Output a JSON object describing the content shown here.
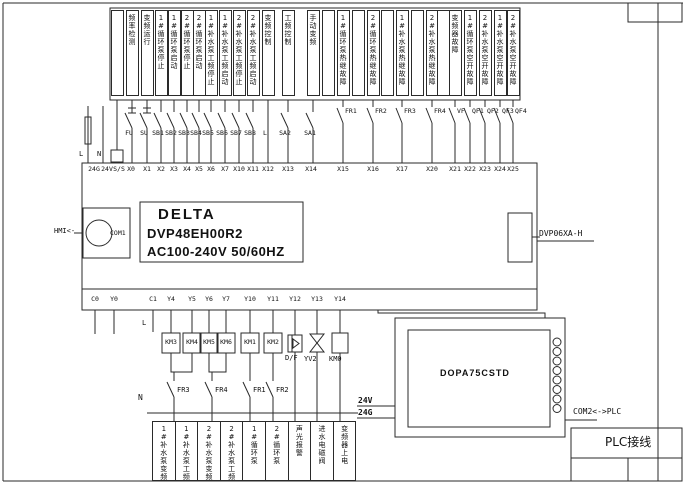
{
  "title_block": {
    "title": "PLC接线"
  },
  "plc": {
    "brand": "DELTA",
    "model": "DVP48EH00R2",
    "power": "AC100-240V 50/60HZ"
  },
  "ports": {
    "hmi_label": "HMI<-",
    "com1": "COM1",
    "expansion": "DVP06XA-H",
    "com2": "COM2<->PLC"
  },
  "hmi_panel": {
    "model": "DOPA75CSTD",
    "supply_24v": "24V",
    "supply_24g": "24G"
  },
  "power_in": {
    "l": "L",
    "n": "N"
  },
  "output_common": {
    "l": "L",
    "n": "N"
  },
  "load_labels": {
    "df": "D/F",
    "yv2": "YV2",
    "km0": "KM0"
  },
  "top_signals": [
    {
      "x": 117,
      "label": ""
    },
    {
      "x": 132,
      "label": "频率检测"
    },
    {
      "x": 147,
      "label": "变频运行"
    },
    {
      "x": 161,
      "label": "1#循环泵停止"
    },
    {
      "x": 174,
      "label": "1#循环泵启动"
    },
    {
      "x": 187,
      "label": "2#循环泵停止"
    },
    {
      "x": 199,
      "label": "2#循环泵启动"
    },
    {
      "x": 211,
      "label": "1#补水泵工频停止"
    },
    {
      "x": 225,
      "label": "1#补水泵工频启动"
    },
    {
      "x": 239,
      "label": "2#补水泵工频停止"
    },
    {
      "x": 253,
      "label": "2#补水泵工频启动"
    },
    {
      "x": 268,
      "label": "变频控制"
    },
    {
      "x": 288,
      "label": "工频控制"
    },
    {
      "x": 313,
      "label": "手动变频"
    },
    {
      "x": 328,
      "label": ""
    },
    {
      "x": 343,
      "label": "1#循环泵热继故障"
    },
    {
      "x": 358,
      "label": ""
    },
    {
      "x": 373,
      "label": "2#循环泵热继故障"
    },
    {
      "x": 387,
      "label": ""
    },
    {
      "x": 402,
      "label": "1#补水泵热继故障"
    },
    {
      "x": 417,
      "label": ""
    },
    {
      "x": 432,
      "label": "2#补水泵热继故障"
    },
    {
      "x": 443,
      "label": ""
    },
    {
      "x": 455,
      "label": "变频器故障"
    },
    {
      "x": 470,
      "label": "1#循环泵空开故障"
    },
    {
      "x": 485,
      "label": "2#补水泵空开故障"
    },
    {
      "x": 500,
      "label": "1#补水泵空开故障"
    },
    {
      "x": 513,
      "label": "2#补水泵空开故障"
    }
  ],
  "input_terminals": [
    {
      "x": 94,
      "label": "24G"
    },
    {
      "x": 107,
      "label": "24V"
    },
    {
      "x": 119,
      "label": "S/S"
    },
    {
      "x": 131,
      "label": "X0"
    },
    {
      "x": 147,
      "label": "X1"
    },
    {
      "x": 161,
      "label": "X2"
    },
    {
      "x": 174,
      "label": "X3"
    },
    {
      "x": 187,
      "label": "X4"
    },
    {
      "x": 199,
      "label": "X5"
    },
    {
      "x": 211,
      "label": "X6"
    },
    {
      "x": 225,
      "label": "X7"
    },
    {
      "x": 239,
      "label": "X10"
    },
    {
      "x": 253,
      "label": "X11"
    },
    {
      "x": 268,
      "label": "X12"
    },
    {
      "x": 288,
      "label": "X13"
    },
    {
      "x": 311,
      "label": "X14"
    },
    {
      "x": 343,
      "label": "X15"
    },
    {
      "x": 373,
      "label": "X16"
    },
    {
      "x": 402,
      "label": "X17"
    },
    {
      "x": 432,
      "label": "X20"
    },
    {
      "x": 455,
      "label": "X21"
    },
    {
      "x": 470,
      "label": "X22"
    },
    {
      "x": 485,
      "label": "X23"
    },
    {
      "x": 500,
      "label": "X24"
    },
    {
      "x": 513,
      "label": "X25"
    }
  ],
  "input_devices": [
    {
      "x": 117,
      "label": "",
      "type": "block"
    },
    {
      "x": 132,
      "label": "FU",
      "type": "fuse"
    },
    {
      "x": 147,
      "label": "SU",
      "type": "fuse"
    },
    {
      "x": 161,
      "label": "SB1",
      "type": "switch"
    },
    {
      "x": 174,
      "label": "SB2",
      "type": "switch"
    },
    {
      "x": 187,
      "label": "SB3",
      "type": "switch"
    },
    {
      "x": 199,
      "label": "SB4",
      "type": "switch"
    },
    {
      "x": 211,
      "label": "SB5",
      "type": "switch"
    },
    {
      "x": 225,
      "label": "SB6",
      "type": "switch"
    },
    {
      "x": 239,
      "label": "SB7",
      "type": "switch"
    },
    {
      "x": 253,
      "label": "SB8",
      "type": "switch"
    },
    {
      "x": 268,
      "label": "L",
      "type": "plain"
    },
    {
      "x": 288,
      "label": "SA2",
      "type": "switch"
    },
    {
      "x": 313,
      "label": "SA1",
      "type": "switch"
    },
    {
      "x": 343,
      "label": "FR1",
      "type": "relay"
    },
    {
      "x": 373,
      "label": "FR2",
      "type": "relay"
    },
    {
      "x": 402,
      "label": "FR3",
      "type": "relay"
    },
    {
      "x": 432,
      "label": "FR4",
      "type": "relay"
    },
    {
      "x": 455,
      "label": "VF",
      "type": "relay"
    },
    {
      "x": 470,
      "label": "QF1",
      "type": "relay"
    },
    {
      "x": 485,
      "label": "QF2",
      "type": "relay"
    },
    {
      "x": 500,
      "label": "QF3",
      "type": "relay"
    },
    {
      "x": 513,
      "label": "QF4",
      "type": "relay"
    }
  ],
  "output_terminals": [
    {
      "x": 95,
      "label": "C0",
      "to": 334,
      "stub": true
    },
    {
      "x": 114,
      "label": "Y0",
      "to": 334,
      "stub": true
    },
    {
      "x": 153,
      "label": "C1",
      "to": 332,
      "stub": true
    },
    {
      "x": 171,
      "label": "Y4",
      "to": 333
    },
    {
      "x": 192,
      "label": "Y5",
      "to": 333
    },
    {
      "x": 209,
      "label": "Y6",
      "to": 333
    },
    {
      "x": 226,
      "label": "Y7",
      "to": 333
    },
    {
      "x": 250,
      "label": "Y10",
      "to": 333
    },
    {
      "x": 273,
      "label": "Y11",
      "to": 333
    },
    {
      "x": 295,
      "label": "Y12",
      "to": 335
    },
    {
      "x": 317,
      "label": "Y13",
      "to": 334
    },
    {
      "x": 340,
      "label": "Y14",
      "to": 333
    }
  ],
  "contactors": [
    {
      "x": 171,
      "label": "KM3"
    },
    {
      "x": 192,
      "label": "KM4"
    },
    {
      "x": 209,
      "label": "KM5"
    },
    {
      "x": 226,
      "label": "KM6"
    },
    {
      "x": 250,
      "label": "KM1"
    },
    {
      "x": 273,
      "label": "KM2"
    }
  ],
  "fr_contacts": [
    {
      "x": 174,
      "label": "FR3"
    },
    {
      "x": 212,
      "label": "FR4"
    },
    {
      "x": 250,
      "label": "FR1"
    },
    {
      "x": 273,
      "label": "FR2"
    }
  ],
  "bottom_signals": [
    "1#补水泵变频",
    "1#补水泵工频",
    "2#补水泵变频",
    "2#补水泵工频",
    "1#循环泵",
    "2#循环泵",
    "声光报警",
    "进水电磁阀",
    "变频器上电"
  ]
}
